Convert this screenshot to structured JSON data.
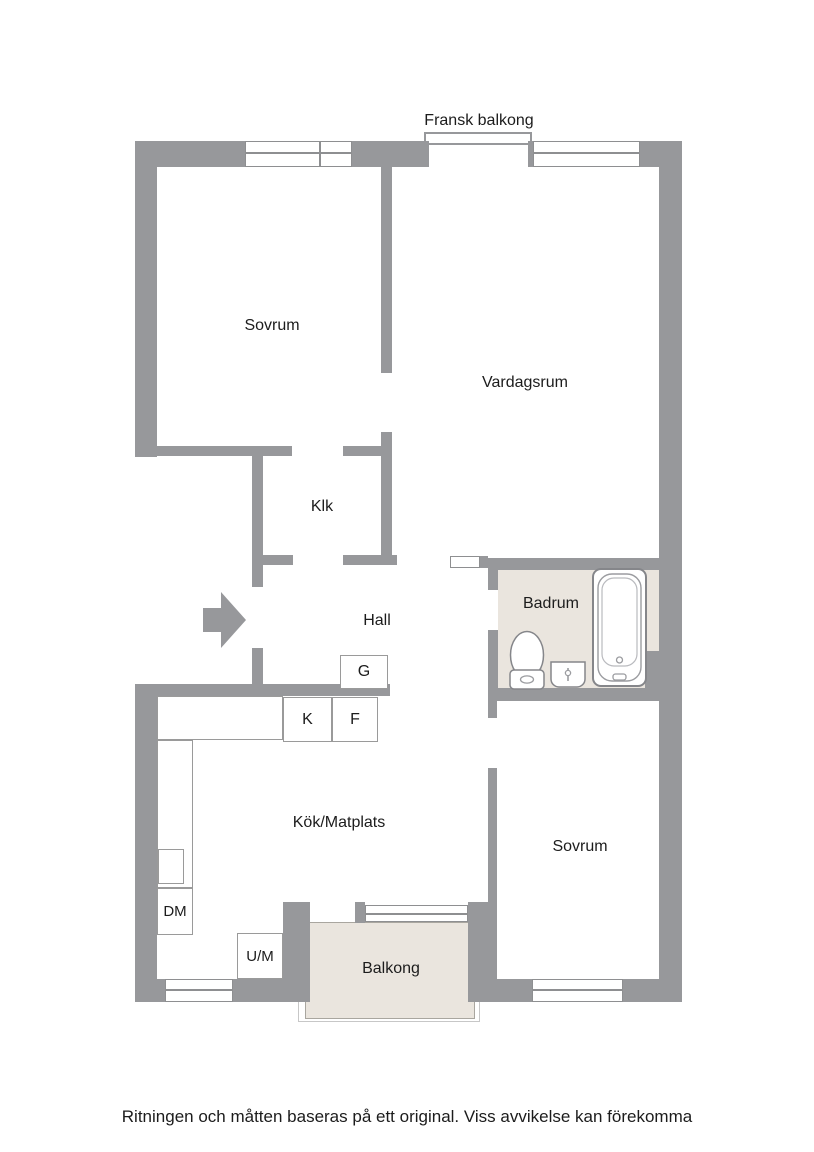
{
  "colors": {
    "wall": "#97989b",
    "line": "#8e8f91",
    "floor": "#eae5de",
    "frame": "#c7c7c7",
    "box_border": "#9a9a9a",
    "text": "#1c1c1c"
  },
  "labels": {
    "french_balcony": "Fransk balkong"
  },
  "rooms": {
    "bedroom_top": "Sovrum",
    "living_room": "Vardagsrum",
    "walk_in_closet": "Klk",
    "hall": "Hall",
    "bathroom": "Badrum",
    "kitchen_dining": "Kök/Matplats",
    "bedroom_bottom": "Sovrum",
    "balcony": "Balkong"
  },
  "appliances": {
    "wardrobe": "G",
    "fridge": "K",
    "freezer": "F",
    "dishwasher": "DM",
    "oven_microwave": "U/M"
  },
  "footer": {
    "disclaimer": "Ritningen och måtten baseras på ett original. Viss avvikelse kan förekomma"
  }
}
